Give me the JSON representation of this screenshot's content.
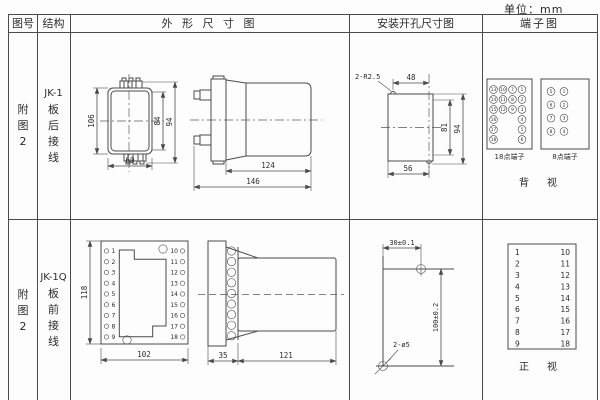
{
  "unit_label": "单位：mm",
  "header": {
    "fig": "图号",
    "structure": "结构",
    "outline": "外 形 尺 寸 图",
    "install": "安装开孔尺寸图",
    "terminal": "端子图"
  },
  "row1": {
    "fig": {
      "l0": "附",
      "l1": "图",
      "l2": "2"
    },
    "structure": {
      "model": "JK-1",
      "l0": "板",
      "l1": "后",
      "l2": "接",
      "l3": "线"
    },
    "outline": {
      "front": {
        "height": "106",
        "inner": "84",
        "outer": "94",
        "width": "60"
      },
      "side": {
        "body": "124",
        "total": "146"
      }
    },
    "install": {
      "radius_note": "2-R2.5",
      "top": "48",
      "inner": "81",
      "outer": "94",
      "bottom": "56"
    },
    "terminal": {
      "b18": {
        "label": "18点端子",
        "r0": [
          "13",
          "10",
          "7",
          "1"
        ],
        "r1": [
          "14",
          "11",
          "8",
          "2"
        ],
        "r2": [
          "15",
          "12",
          "9",
          "3"
        ],
        "r3": [
          "16",
          "4"
        ],
        "r4": [
          "17",
          "5"
        ],
        "r5": [
          "18",
          "6"
        ]
      },
      "b8": {
        "label": "8点端子",
        "r0": [
          "5",
          "1"
        ],
        "r1": [
          "6",
          "2"
        ],
        "r2": [
          "7",
          "3"
        ],
        "r3": [
          "8",
          "4"
        ]
      },
      "view": "背　视"
    }
  },
  "row2": {
    "fig": {
      "l0": "附",
      "l1": "图",
      "l2": "2"
    },
    "structure": {
      "model": "JK-1Q",
      "l0": "板",
      "l1": "前",
      "l2": "接",
      "l3": "线"
    },
    "outline": {
      "front": {
        "height": "118",
        "width": "102",
        "left": [
          "1",
          "2",
          "3",
          "4",
          "5",
          "6",
          "7",
          "8",
          "9"
        ],
        "right": [
          "10",
          "11",
          "12",
          "13",
          "14",
          "15",
          "16",
          "17",
          "18"
        ]
      },
      "side": {
        "depth": "35",
        "body": "121"
      }
    },
    "install": {
      "top": "30±0.1",
      "right": "100±0.2",
      "holes_note": "2-ø5"
    },
    "terminal": {
      "left": [
        "1",
        "2",
        "3",
        "4",
        "5",
        "6",
        "7",
        "8",
        "9"
      ],
      "right": [
        "10",
        "11",
        "12",
        "13",
        "14",
        "15",
        "16",
        "17",
        "18"
      ],
      "view": "正　视"
    }
  }
}
